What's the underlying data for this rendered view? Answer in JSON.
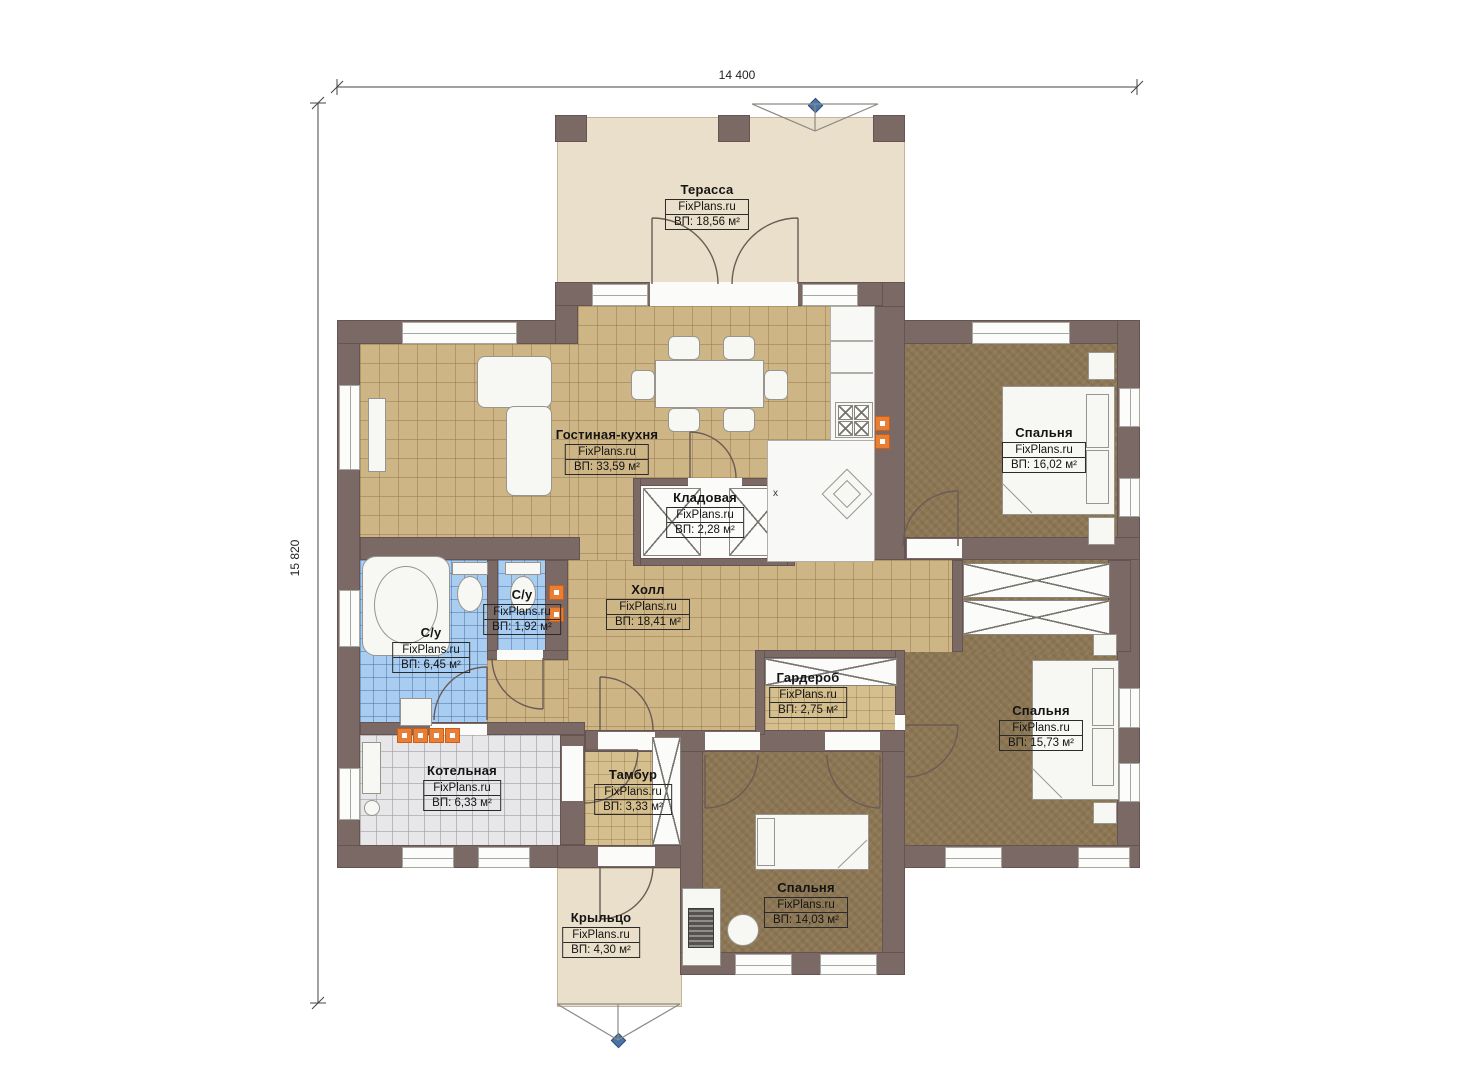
{
  "dimensions": {
    "width": "14 400",
    "height": "15 820"
  },
  "markers": {
    "kitchen_x": "х"
  },
  "rooms": [
    {
      "name": "Терасса",
      "brand": "FixPlans.ru",
      "area": "ВП: 18,56 м²"
    },
    {
      "name": "Гостиная-кухня",
      "brand": "FixPlans.ru",
      "area": "ВП: 33,59 м²"
    },
    {
      "name": "Кладовая",
      "brand": "FixPlans.ru",
      "area": "ВП: 2,28 м²"
    },
    {
      "name": "Спальня",
      "brand": "FixPlans.ru",
      "area": "ВП: 16,02 м²"
    },
    {
      "name": "Холл",
      "brand": "FixPlans.ru",
      "area": "ВП: 18,41 м²"
    },
    {
      "name": "С/у",
      "brand": "FixPlans.ru",
      "area": "ВП: 1,92 м²"
    },
    {
      "name": "С/у",
      "brand": "FixPlans.ru",
      "area": "ВП: 6,45 м²"
    },
    {
      "name": "Гардероб",
      "brand": "FixPlans.ru",
      "area": "ВП: 2,75 м²"
    },
    {
      "name": "Спальня",
      "brand": "FixPlans.ru",
      "area": "ВП: 15,73 м²"
    },
    {
      "name": "Котельная",
      "brand": "FixPlans.ru",
      "area": "ВП: 6,33 м²"
    },
    {
      "name": "Тамбур",
      "brand": "FixPlans.ru",
      "area": "ВП: 3,33 м²"
    },
    {
      "name": "Спальня",
      "brand": "FixPlans.ru",
      "area": "ВП: 14,03 м²"
    },
    {
      "name": "Крыльцо",
      "brand": "FixPlans.ru",
      "area": "ВП: 4,30 м²"
    }
  ],
  "colors": {
    "wall": "#7b6966",
    "tile_tan": "#cdb586",
    "carpet": "#8d7754",
    "bath_blue": "#a9cdf0",
    "terrace": "#eadfca",
    "radiator": "#e87f35",
    "marker_blue": "#4a74a8"
  }
}
